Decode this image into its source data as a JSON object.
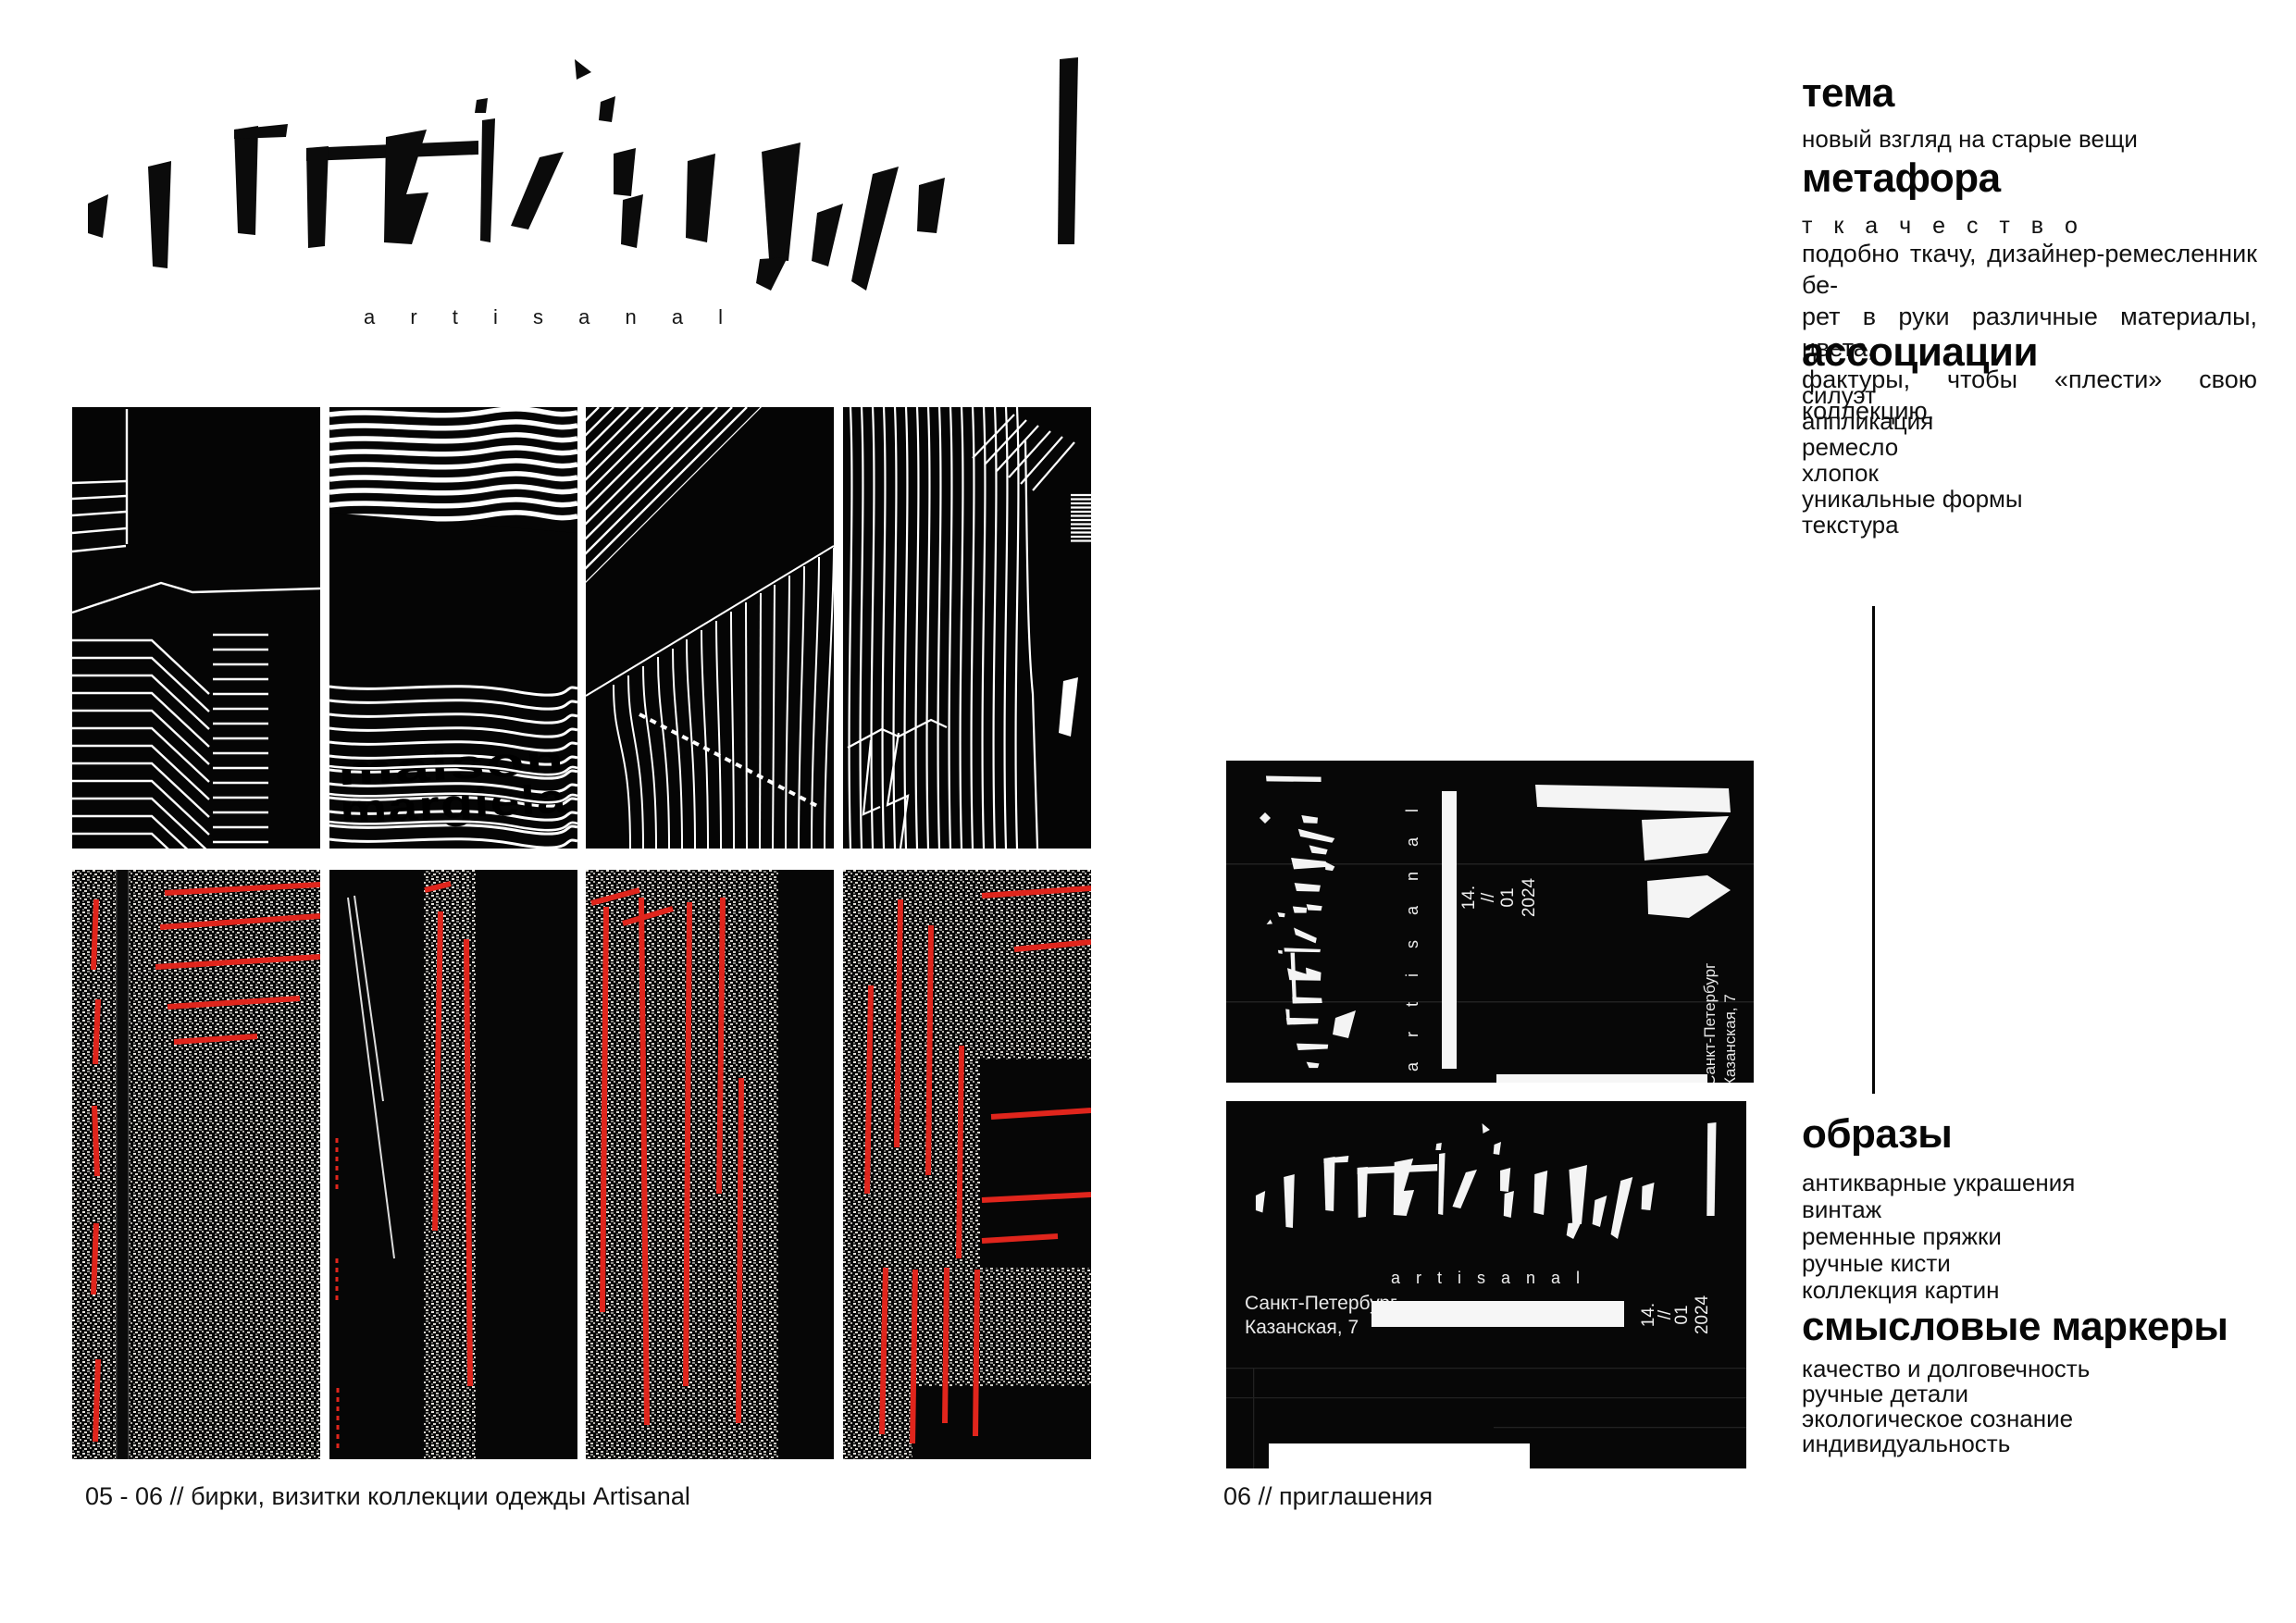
{
  "brand": {
    "wordmark": "artisanal",
    "wordmark_spaced": "a r t i s a n a l"
  },
  "tag_panels": {
    "margiela_line1": "maison",
    "margiela_line2": "margiela"
  },
  "invitation": {
    "brand_spaced": "a r t i s a n a l",
    "date_day": "14.",
    "date_slashes": "//",
    "date_month": "01",
    "date_year": "2024",
    "address_line1": "Санкт-Петербург",
    "address_line2": "Казанская, 7"
  },
  "right_column": {
    "sections": [
      {
        "heading": "тема",
        "items": [
          "новый взгляд на старые вещи"
        ]
      },
      {
        "heading": "метафора",
        "lead": "т к а ч е с т в о",
        "paragraph_lines": [
          "подобно ткачу, дизайнер-ремесленник бе-",
          "рет в руки различные материалы, цвета,",
          "фактуры, чтобы «плести» свою коллекцию."
        ]
      },
      {
        "heading": "ассоциации",
        "items": [
          "силуэт",
          "аппликация",
          "ремесло",
          "хлопок",
          "уникальные формы",
          "текстура"
        ]
      },
      {
        "heading": "образы",
        "items": [
          "антикварные украшения",
          "винтаж",
          "ременные пряжки",
          "ручные кисти",
          "коллекция картин"
        ]
      },
      {
        "heading": "смысловые маркеры",
        "items": [
          "качество и долговечность",
          "ручные детали",
          "экологическое сознание",
          "индивидуальность"
        ]
      }
    ]
  },
  "captions": {
    "left": "05 - 06 // бирки, визитки коллекции одежды Artisanal",
    "right": "06 // приглашения"
  },
  "colors": {
    "paper": "#ffffff",
    "ink": "#000000",
    "stitch_red": "#e0251c"
  }
}
